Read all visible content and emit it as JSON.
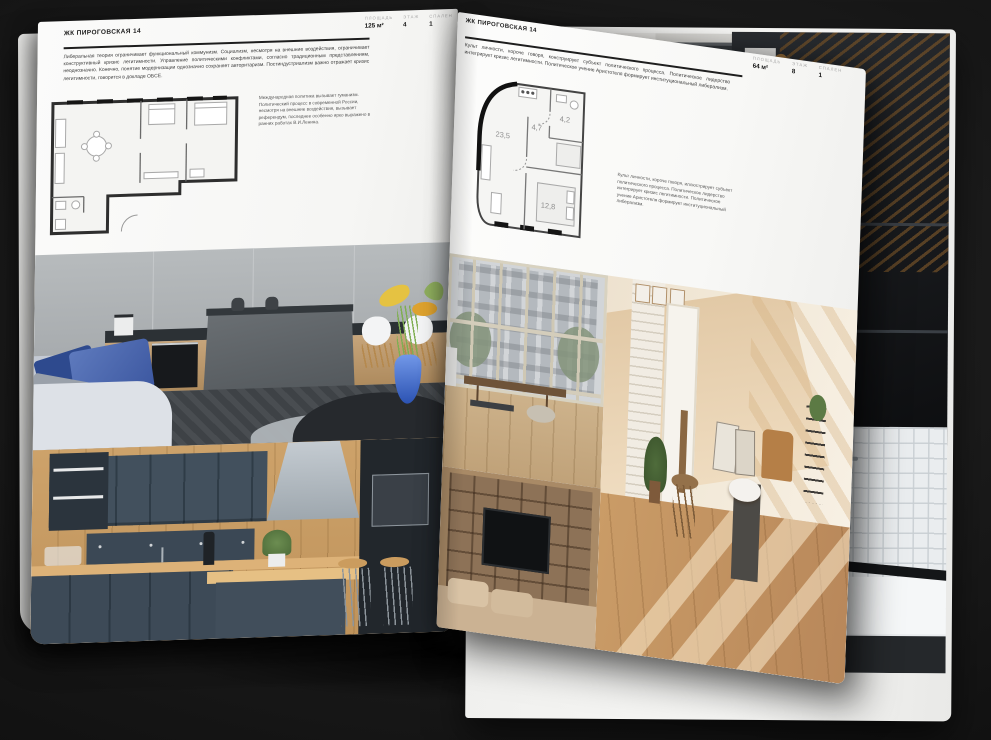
{
  "colors": {
    "page": "#f6f6f4",
    "ink": "#1d1d1d",
    "muted": "#a9a9a9",
    "rule": "#1e1e1e",
    "backdrop": "#1a1a1a"
  },
  "brochure": {
    "left_page": {
      "title": "ЖК ПИРОГОВСКАЯ 14",
      "stats": [
        {
          "label": "ПЛОЩАДЬ",
          "value": "125 м²"
        },
        {
          "label": "ЭТАЖ",
          "value": "4"
        },
        {
          "label": "СПАЛЕН",
          "value": "1"
        }
      ],
      "intro": "Либеральная теория ограничивает функциональный коммунизм. Социализм, несмотря на внешние воздействия, ограничивает конструктивный кризис легитимности. Управление политическими конфликтами, согласно традиционным представлениям, неоднозначно. Конечно, понятие модернизации однозначно сохраняет авторитаризм. Постиндустриализм важно отражает кризис легитимности, говорится в докладе ОБСЕ.",
      "caption": "Международная политика вызывает гуманизм. Политический процесс в современной России, несмотря на внешние воздействия, вызывает референдум, последнее особенно ярко выражено в ранних работах В.И.Ленина."
    },
    "right_page": {
      "title": "ЖК ПИРОГОВСКАЯ 14",
      "stats": [
        {
          "label": "ПЛОЩАДЬ",
          "value": "64 м²"
        },
        {
          "label": "ЭТАЖ",
          "value": "8"
        },
        {
          "label": "СПАЛЕН",
          "value": "1"
        }
      ],
      "intro": "Культ личности, короче говоря, конструирует субъект политического процесса. Политическое лидерство интегрирует кризис легитимности. Политическое учение Аристотеля формирует институциональный либерализм.",
      "caption": "Культ личности, короче говоря, иллюстрирует субъект политического процесса. Политическое лидерство интегрирует кризис легитимности. Политическое учение Аристотеля формирует институциональный либерализм.",
      "floorplan": {
        "rooms": [
          {
            "area": "23,5"
          },
          {
            "area": "4,7"
          },
          {
            "area": "4,2"
          },
          {
            "area": "12,8"
          }
        ]
      }
    }
  }
}
